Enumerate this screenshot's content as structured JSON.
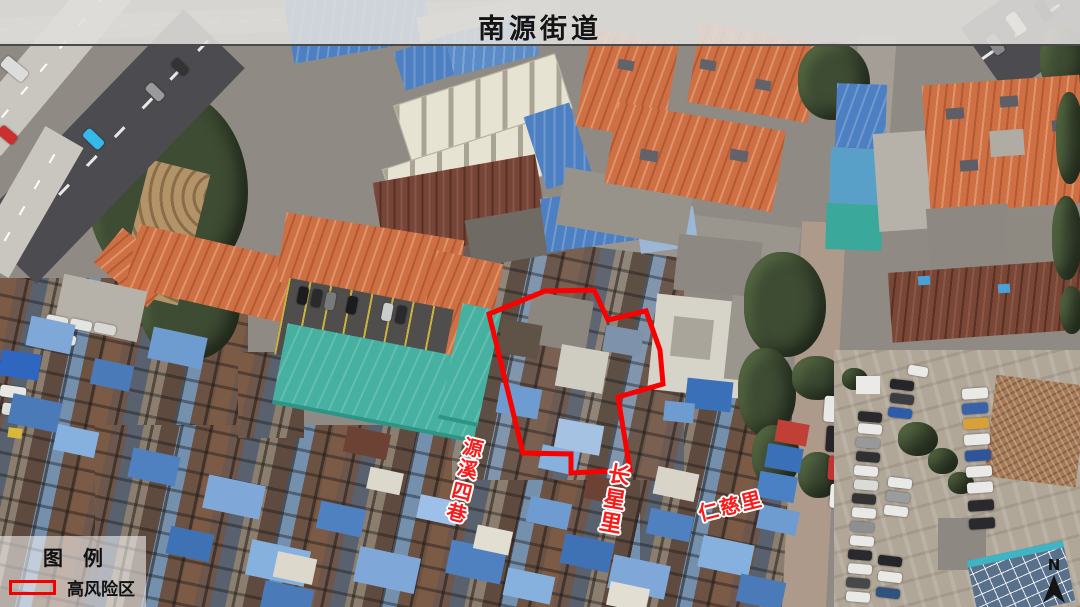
{
  "header": {
    "title": "南源街道"
  },
  "map": {
    "street_labels": [
      {
        "text": "源溪四巷",
        "orientation": "vertical",
        "color": "#fa1a1a"
      },
      {
        "text": "长星里",
        "orientation": "vertical",
        "color": "#fa1a1a"
      },
      {
        "text": "仁慈里",
        "orientation": "diagonal",
        "color": "#fa1a1a"
      }
    ],
    "high_risk_zone": {
      "stroke_color": "#fa0000",
      "points": "489,314 545,291 594,290 608,320 646,311 660,350 663,384 618,397 630,470 571,473 571,454 523,453"
    }
  },
  "legend": {
    "title": "图　例",
    "items": [
      {
        "label": "高风险区",
        "swatch": "red-outline-rectangle",
        "swatch_color": "#f50000"
      }
    ]
  },
  "compass": {
    "label": "N"
  }
}
